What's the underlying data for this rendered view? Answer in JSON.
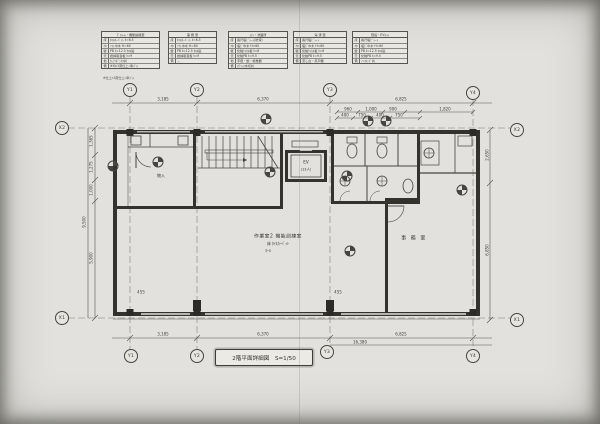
{
  "sheet": {
    "kind": "architectural floor plan (scanned blueprint)",
    "title_block": "2階平面詳細図　S=1/50",
    "table_caption": "※仕上ﾊ1階仕上ﾆ準ｽﾞﾙ",
    "ink_color": "#3c3c37",
    "paper_color": "#e2e1dd"
  },
  "tables": [
    {
      "x": 101,
      "y": 31,
      "w": 57,
      "title": "ﾃﾞｲﾙｰﾑ・機能訓練室",
      "rows": [
        [
          "床",
          "ﾀｲﾙｶｰﾍﾟｯﾄ t=6.5"
        ],
        [
          "巾",
          "ｿﾌﾄ巾木 H=60"
        ],
        [
          "壁",
          "PB t=12.5 ｸﾛｽ貼"
        ],
        [
          "天",
          "岩綿吸音板 t=9"
        ],
        [
          "他",
          "ｶｰﾃﾝﾎﾞｯｸｽ共"
        ],
        [
          "備",
          "※印ﾊ1階仕上ﾆ準ｽﾞﾙ"
        ]
      ]
    },
    {
      "x": 168,
      "y": 31,
      "w": 47,
      "title": "事 務 室",
      "rows": [
        [
          "床",
          "ﾀｲﾙｶｰﾍﾟｯﾄ t=6.5"
        ],
        [
          "巾",
          "ｿﾌﾄ巾木 H=60"
        ],
        [
          "壁",
          "PB t=12.5 ｸﾛｽ貼"
        ],
        [
          "天",
          "岩綿吸音板 t=9"
        ],
        [
          "備",
          "－"
        ]
      ]
    },
    {
      "x": 228,
      "y": 31,
      "w": 58,
      "title": "ﾄｲﾚ・洗面所",
      "rows": [
        [
          "床",
          "長尺塩ﾋﾞｼｰﾄ(防滑)"
        ],
        [
          "巾",
          "塩ﾋﾞ巾木 H=60"
        ],
        [
          "壁",
          "化粧ｹｲｶﾙ板 t=6"
        ],
        [
          "天",
          "化粧PB t=9.5"
        ],
        [
          "他",
          "手摺・鏡・紙巻器"
        ],
        [
          "備",
          "ｽﾃﾝﾚｽ水切共"
        ]
      ]
    },
    {
      "x": 293,
      "y": 31,
      "w": 52,
      "title": "湯 沸 室",
      "rows": [
        [
          "床",
          "長尺塩ﾋﾞｼｰﾄ"
        ],
        [
          "巾",
          "塩ﾋﾞ巾木 H=60"
        ],
        [
          "壁",
          "化粧ｹｲｶﾙ板 t=6"
        ],
        [
          "天",
          "化粧PB t=9.5"
        ],
        [
          "備",
          "流し台・吊戸棚"
        ]
      ]
    },
    {
      "x": 352,
      "y": 31,
      "w": 54,
      "title": "階段・EVﾎｰﾙ",
      "rows": [
        [
          "床",
          "長尺塩ﾋﾞｼｰﾄ"
        ],
        [
          "巾",
          "塩ﾋﾞ巾木 H=60"
        ],
        [
          "壁",
          "PB t=12.5 ｸﾛｽ貼"
        ],
        [
          "天",
          "化粧PB t=9.5"
        ],
        [
          "備",
          "ﾉﾝｽﾘｯﾌﾟ共"
        ]
      ]
    }
  ],
  "rooms": {
    "main": {
      "lines": [
        "作業室2 機能訓練室",
        "床 ﾀｲﾙｶｰﾍﾟｯﾄ",
        "ﾎｰﾙ"
      ]
    },
    "office": {
      "label": "事 務 室"
    },
    "closet": {
      "label": "物入"
    },
    "elevator": {
      "line1": "EV",
      "line2": "(13人)"
    }
  },
  "grid": {
    "bubbles": [
      {
        "l": "Y1",
        "x": 130,
        "y": 90
      },
      {
        "l": "Y2",
        "x": 197,
        "y": 90
      },
      {
        "l": "Y3",
        "x": 330,
        "y": 90
      },
      {
        "l": "Y4",
        "x": 473,
        "y": 93
      },
      {
        "l": "Y1",
        "x": 131,
        "y": 356
      },
      {
        "l": "Y2",
        "x": 197,
        "y": 356
      },
      {
        "l": "Y3",
        "x": 327,
        "y": 352
      },
      {
        "l": "Y4",
        "x": 473,
        "y": 356
      },
      {
        "l": "X2",
        "x": 62,
        "y": 128
      },
      {
        "l": "X1",
        "x": 62,
        "y": 318
      },
      {
        "l": "X2",
        "x": 517,
        "y": 130
      },
      {
        "l": "X1",
        "x": 517,
        "y": 320
      }
    ]
  },
  "dim_labels": [
    {
      "t": "3,185",
      "x": 163,
      "y": 99
    },
    {
      "t": "6,370",
      "x": 263,
      "y": 99
    },
    {
      "t": "6,825",
      "x": 401,
      "y": 99
    },
    {
      "t": "960",
      "x": 348,
      "y": 109
    },
    {
      "t": "1,000",
      "x": 371,
      "y": 109
    },
    {
      "t": "900",
      "x": 393,
      "y": 109
    },
    {
      "t": "1,820",
      "x": 445,
      "y": 109
    },
    {
      "t": "400",
      "x": 345,
      "y": 115
    },
    {
      "t": "750",
      "x": 362,
      "y": 115
    },
    {
      "t": "400",
      "x": 380,
      "y": 115
    },
    {
      "t": "750",
      "x": 399,
      "y": 115
    },
    {
      "t": "3,185",
      "x": 163,
      "y": 334
    },
    {
      "t": "6,370",
      "x": 263,
      "y": 334
    },
    {
      "t": "6,825",
      "x": 401,
      "y": 334
    },
    {
      "t": "16,380",
      "x": 360,
      "y": 342
    },
    {
      "t": "1,365",
      "x": 91,
      "y": 141,
      "rot": 1
    },
    {
      "t": "1,275",
      "x": 91,
      "y": 167,
      "rot": 1
    },
    {
      "t": "1,000",
      "x": 91,
      "y": 190,
      "rot": 1
    },
    {
      "t": "5,900",
      "x": 91,
      "y": 258,
      "rot": 1
    },
    {
      "t": "9,500",
      "x": 84,
      "y": 222,
      "rot": 1
    },
    {
      "t": "2,650",
      "x": 487,
      "y": 155,
      "rot": 1
    },
    {
      "t": "6,850",
      "x": 487,
      "y": 250,
      "rot": 1
    },
    {
      "t": "455",
      "x": 141,
      "y": 292
    },
    {
      "t": "455",
      "x": 338,
      "y": 292
    }
  ],
  "markers": [
    {
      "x": 266,
      "y": 119
    },
    {
      "x": 368,
      "y": 121
    },
    {
      "x": 386,
      "y": 121
    },
    {
      "x": 158,
      "y": 162
    },
    {
      "x": 113,
      "y": 166
    },
    {
      "x": 270,
      "y": 172
    },
    {
      "x": 347,
      "y": 176
    },
    {
      "x": 462,
      "y": 190
    },
    {
      "x": 350,
      "y": 251
    }
  ]
}
